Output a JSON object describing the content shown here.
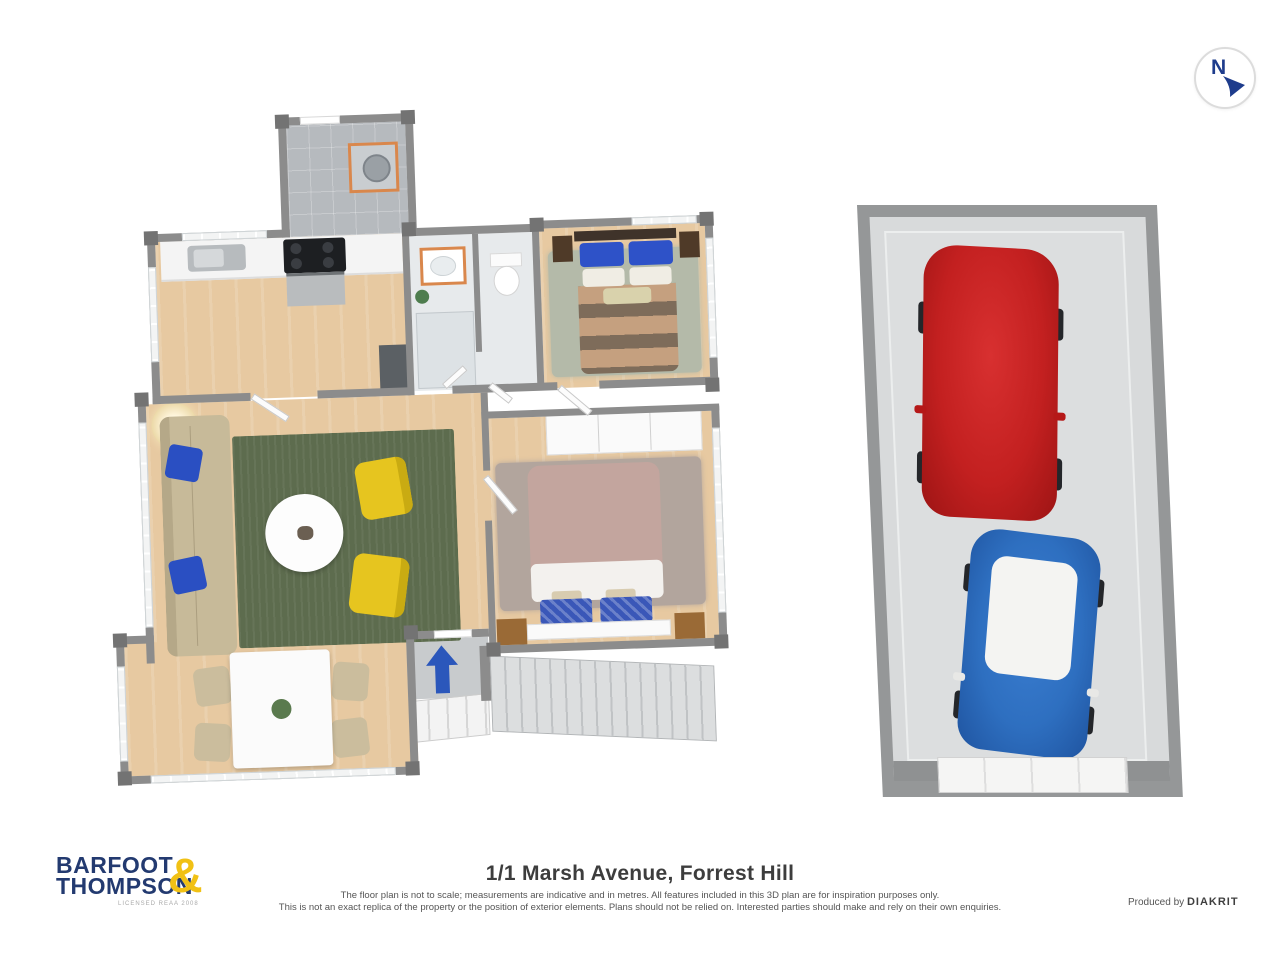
{
  "title": "1/1 Marsh Avenue, Forrest Hill",
  "disclaimer": {
    "line1": "The floor plan is not to scale; measurements are indicative and in metres. All features included in this 3D plan are for inspiration purposes only.",
    "line2": "This is not an exact replica of the property or the position of exterior elements. Plans should not be relied on. Interested parties should make and rely on their own enquiries."
  },
  "logo": {
    "word1": "BARFOOT",
    "word2": "THOMPSON",
    "ampersand": "&",
    "tagline": "LICENSED REAA 2008"
  },
  "credit": {
    "prefix": "Produced by ",
    "brand": "DIAKRIT"
  },
  "compass": {
    "label": "N",
    "arrow_direction": "south-east"
  },
  "colors": {
    "logo_navy": "#233a70",
    "logo_yellow": "#f1c115",
    "compass_navy": "#1e3c8c",
    "wall_gray": "#8c8c8c",
    "wood_floor": "#e7c9a1",
    "living_rug_green": "#5d6c4e",
    "bedroom1_rug": "#b4baa9",
    "bedroom2_rug": "#b2a59d",
    "sofa_beige": "#c7ba99",
    "armchair_yellow": "#e6c51f",
    "pillow_blue": "#2e52c8",
    "entry_arrow_blue": "#2b57bb",
    "car_red": "#c32020",
    "car_blue": "#2e6fc0",
    "car_blue_roof": "#f4f4f2",
    "garage_floor": "#d8dadb",
    "highlight_orange": "#d9874c"
  },
  "floor_plan": {
    "rooms": [
      {
        "name": "laundry",
        "items": [
          "washing-machine"
        ]
      },
      {
        "name": "kitchen",
        "items": [
          "kitchen-sink",
          "cooktop",
          "oven",
          "refrigerator",
          "counter"
        ]
      },
      {
        "name": "bathroom",
        "items": [
          "vanity-basin",
          "shower",
          "plant"
        ]
      },
      {
        "name": "toilet-room",
        "items": [
          "toilet"
        ]
      },
      {
        "name": "bedroom-1",
        "items": [
          "double-bed",
          "blue-pillows",
          "nightstand-left",
          "nightstand-right",
          "sage-rug"
        ]
      },
      {
        "name": "hallway",
        "items": []
      },
      {
        "name": "bedroom-2",
        "items": [
          "double-bed",
          "blue-pillows",
          "wardrobe",
          "nightstand-left",
          "nightstand-right",
          "brown-rug"
        ]
      },
      {
        "name": "living-room",
        "items": [
          "sofa",
          "floor-lamp",
          "green-rug",
          "coffee-table",
          "armchair",
          "armchair"
        ]
      },
      {
        "name": "dining-area",
        "items": [
          "dining-table",
          "chair",
          "chair",
          "chair",
          "chair",
          "plant"
        ]
      },
      {
        "name": "entry",
        "items": [
          "entry-arrow",
          "front-door",
          "porch-steps"
        ]
      },
      {
        "name": "staircase",
        "items": []
      }
    ]
  },
  "garage": {
    "cars": [
      {
        "name": "red-car",
        "color": "red"
      },
      {
        "name": "blue-car",
        "color": "blue",
        "roof": "white"
      }
    ],
    "items": [
      "garage-door"
    ]
  }
}
